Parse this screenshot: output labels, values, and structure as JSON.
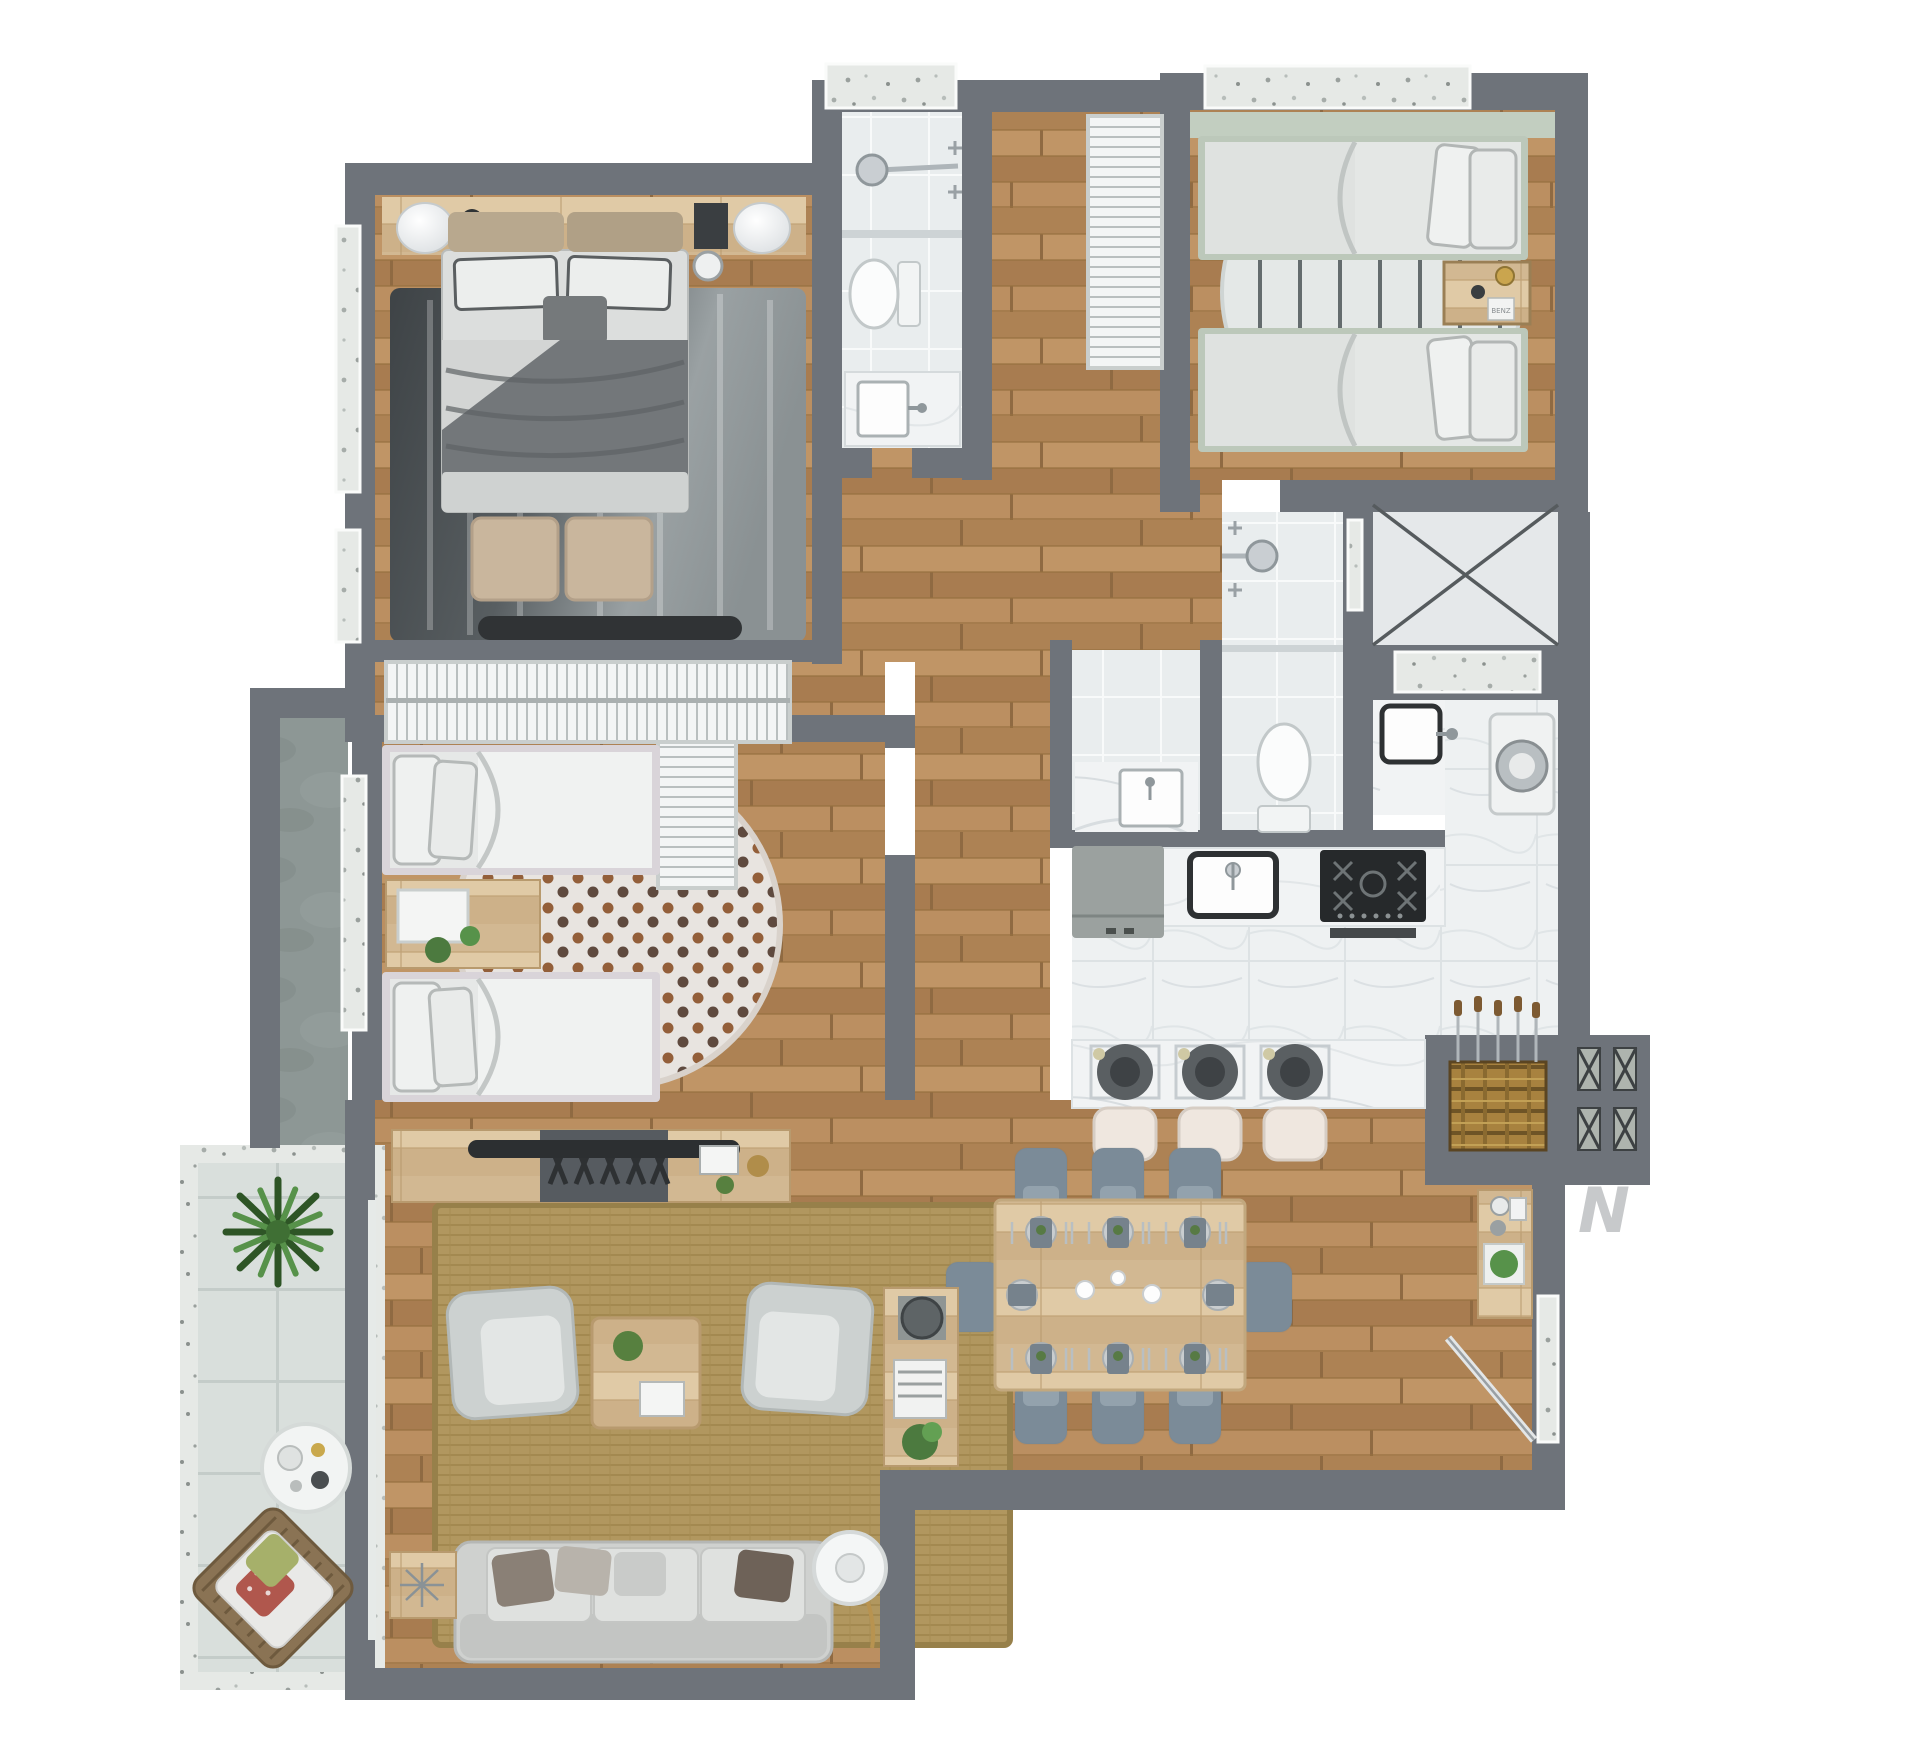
{
  "title": "apartment-3d-floor-plan-top-view",
  "north_indicator": {
    "label": "N",
    "color": "#c7c9cb"
  },
  "decor": {
    "nightstand_box_label": "BENZ"
  },
  "palette": {
    "background": "#ffffff",
    "wall": "#6e737a",
    "wood_floor": "#b5895c",
    "light_wood": "#d8c09c",
    "white_tile": "#eaedee",
    "marble": "#f0f2f3",
    "terrazzo": "#e6e9e6",
    "concrete": "#8d9795",
    "terrace_tile": "#d9dfdc",
    "dark_rug": "#4a4f52",
    "jute_rug": "#b1975f",
    "sage_green": "#bfcabd",
    "slate_chair": "#7b8b98",
    "plant_green": "#4c7a3f",
    "appliance_black": "#2e3133",
    "chrome": "#c9ced2"
  },
  "rooms": [
    {
      "name": "master-bedroom",
      "furniture": [
        "double-bed",
        "dark-area-rug",
        "ottoman-pair",
        "nightstand-lamps",
        "headboard-shelf",
        "tv-panel",
        "wardrobe"
      ]
    },
    {
      "name": "bedroom-2",
      "furniture": [
        "single-bed",
        "single-bed",
        "plant-nightstand",
        "polka-dot-round-rug",
        "slatted-cabinet",
        "media-console"
      ]
    },
    {
      "name": "bedroom-3",
      "furniture": [
        "single-bed",
        "single-bed",
        "wood-nightstand",
        "striped-round-rug",
        "closet-rack"
      ]
    },
    {
      "name": "bathroom-1",
      "furniture": [
        "shower-head",
        "toilet",
        "vanity-sink"
      ]
    },
    {
      "name": "bathroom-2",
      "furniture": [
        "shower-head",
        "toilet",
        "vanity-sink",
        "niche-vanity"
      ]
    },
    {
      "name": "laundry",
      "furniture": [
        "washing-machine",
        "utility-sink",
        "marble-counter"
      ]
    },
    {
      "name": "storage-shaft",
      "furniture": [
        "x-marked-box"
      ]
    },
    {
      "name": "kitchen",
      "furniture": [
        "refrigerator",
        "kitchen-sink",
        "gas-cooktop",
        "marble-island",
        "bar-stools",
        "plates"
      ]
    },
    {
      "name": "barbecue-corner",
      "furniture": [
        "grill-mat",
        "skewers",
        "x-vents",
        "bar-console"
      ]
    },
    {
      "name": "dining-room",
      "furniture": [
        "dining-table",
        "eight-chairs",
        "place-settings"
      ]
    },
    {
      "name": "living-room",
      "furniture": [
        "sofa",
        "armchair",
        "armchair",
        "coffee-table",
        "jute-rug",
        "floor-lamp",
        "side-table",
        "console-with-lamp"
      ]
    },
    {
      "name": "terrace",
      "furniture": [
        "potted-plant",
        "round-side-table",
        "wicker-lounge-chair"
      ]
    },
    {
      "name": "service-balcony",
      "furniture": []
    }
  ]
}
